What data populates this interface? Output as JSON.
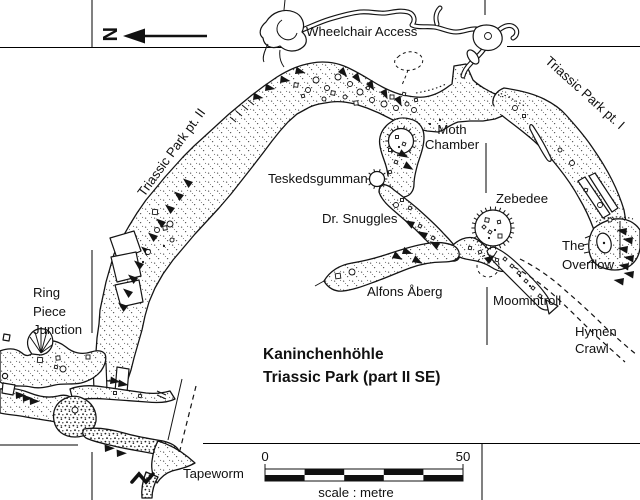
{
  "map": {
    "north": {
      "letter": "N"
    },
    "title": {
      "line1": "Kaninchenhöhle",
      "line2": "Triassic Park (part II SE)"
    },
    "scale_bar": {
      "start": "0",
      "end": "50",
      "caption": "scale : metre"
    },
    "labels": {
      "wheelchair_access": "Wheelchair Access",
      "triassic_park_pt2": "Triassic Park pt. II",
      "triassic_park_pt1": "Triassic Park pt. I",
      "moth_line1": "Moth",
      "moth_line2": "Chamber",
      "teskedsgumman": "Teskedsgumman",
      "dr_snuggles": "Dr. Snuggles",
      "zebedee": "Zebedee",
      "alfons_aberg": "Alfons Åberg",
      "overflow_line1": "The",
      "overflow_line2": "Overflow",
      "ring_line1": "Ring",
      "ring_line2": "Piece",
      "ring_line3": "Junction",
      "moomintroll": "Moomintroll",
      "hymen_line1": "Hymen",
      "hymen_line2": "Crawl",
      "tapeworm": "Tapeworm"
    },
    "colors": {
      "ink": "#141414",
      "paper": "#ffffff"
    }
  }
}
